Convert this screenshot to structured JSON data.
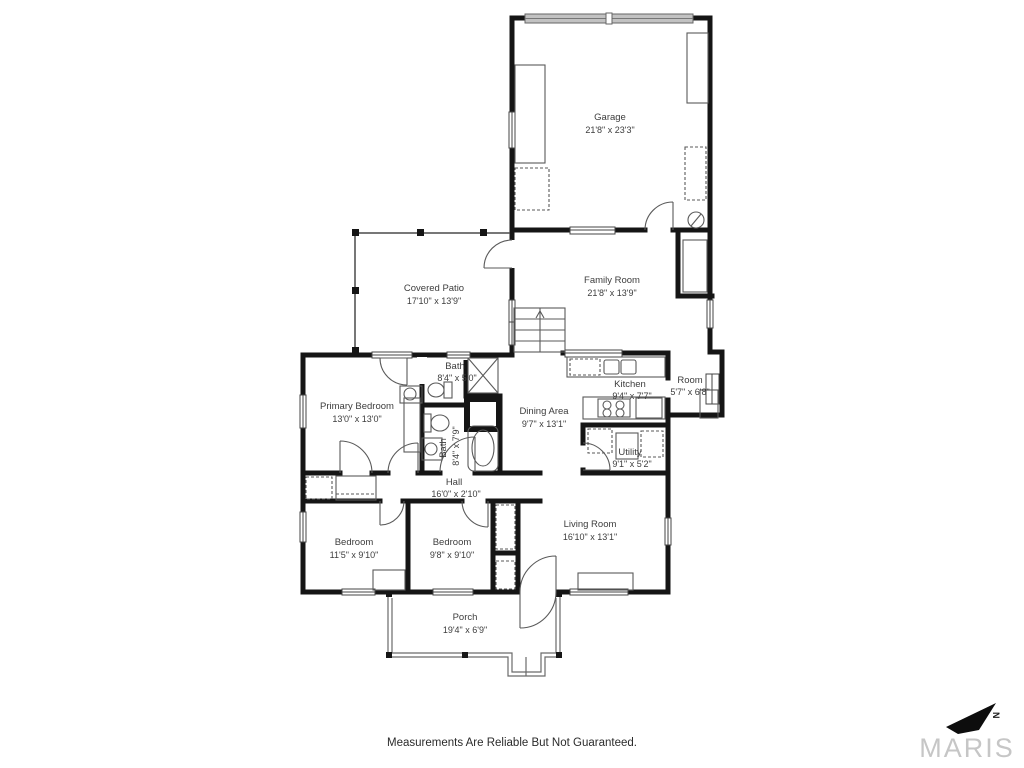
{
  "rooms": {
    "garage": {
      "name": "Garage",
      "dims": "21'8\" x 23'3\""
    },
    "family_room": {
      "name": "Family Room",
      "dims": "21'8\" x 13'9\""
    },
    "covered_patio": {
      "name": "Covered Patio",
      "dims": "17'10\" x 13'9\""
    },
    "bath_upper": {
      "name": "Bath",
      "dims": "8'4\" x 5'0\""
    },
    "primary_bedroom": {
      "name": "Primary Bedroom",
      "dims": "13'0\" x 13'0\""
    },
    "kitchen": {
      "name": "Kitchen",
      "dims": "9'4\" x 7'7\""
    },
    "room": {
      "name": "Room",
      "dims": "5'7\" x 6'8\""
    },
    "dining_area": {
      "name": "Dining Area",
      "dims": "9'7\" x 13'1\""
    },
    "bath_lower": {
      "name": "Bath",
      "dims": "8'4\" x 7'9\""
    },
    "utility": {
      "name": "Utility",
      "dims": "9'1\" x 5'2\""
    },
    "hall": {
      "name": "Hall",
      "dims": "16'0\" x 2'10\""
    },
    "bedroom_left": {
      "name": "Bedroom",
      "dims": "11'5\" x 9'10\""
    },
    "bedroom_middle": {
      "name": "Bedroom",
      "dims": "9'8\" x 9'10\""
    },
    "living_room": {
      "name": "Living Room",
      "dims": "16'10\" x 13'1\""
    },
    "porch": {
      "name": "Porch",
      "dims": "19'4\" x 6'9\""
    }
  },
  "footer": {
    "disclaimer": "Measurements Are Reliable But Not Guaranteed."
  },
  "branding": {
    "logo_text": "MARIS",
    "compass_label": "N"
  }
}
